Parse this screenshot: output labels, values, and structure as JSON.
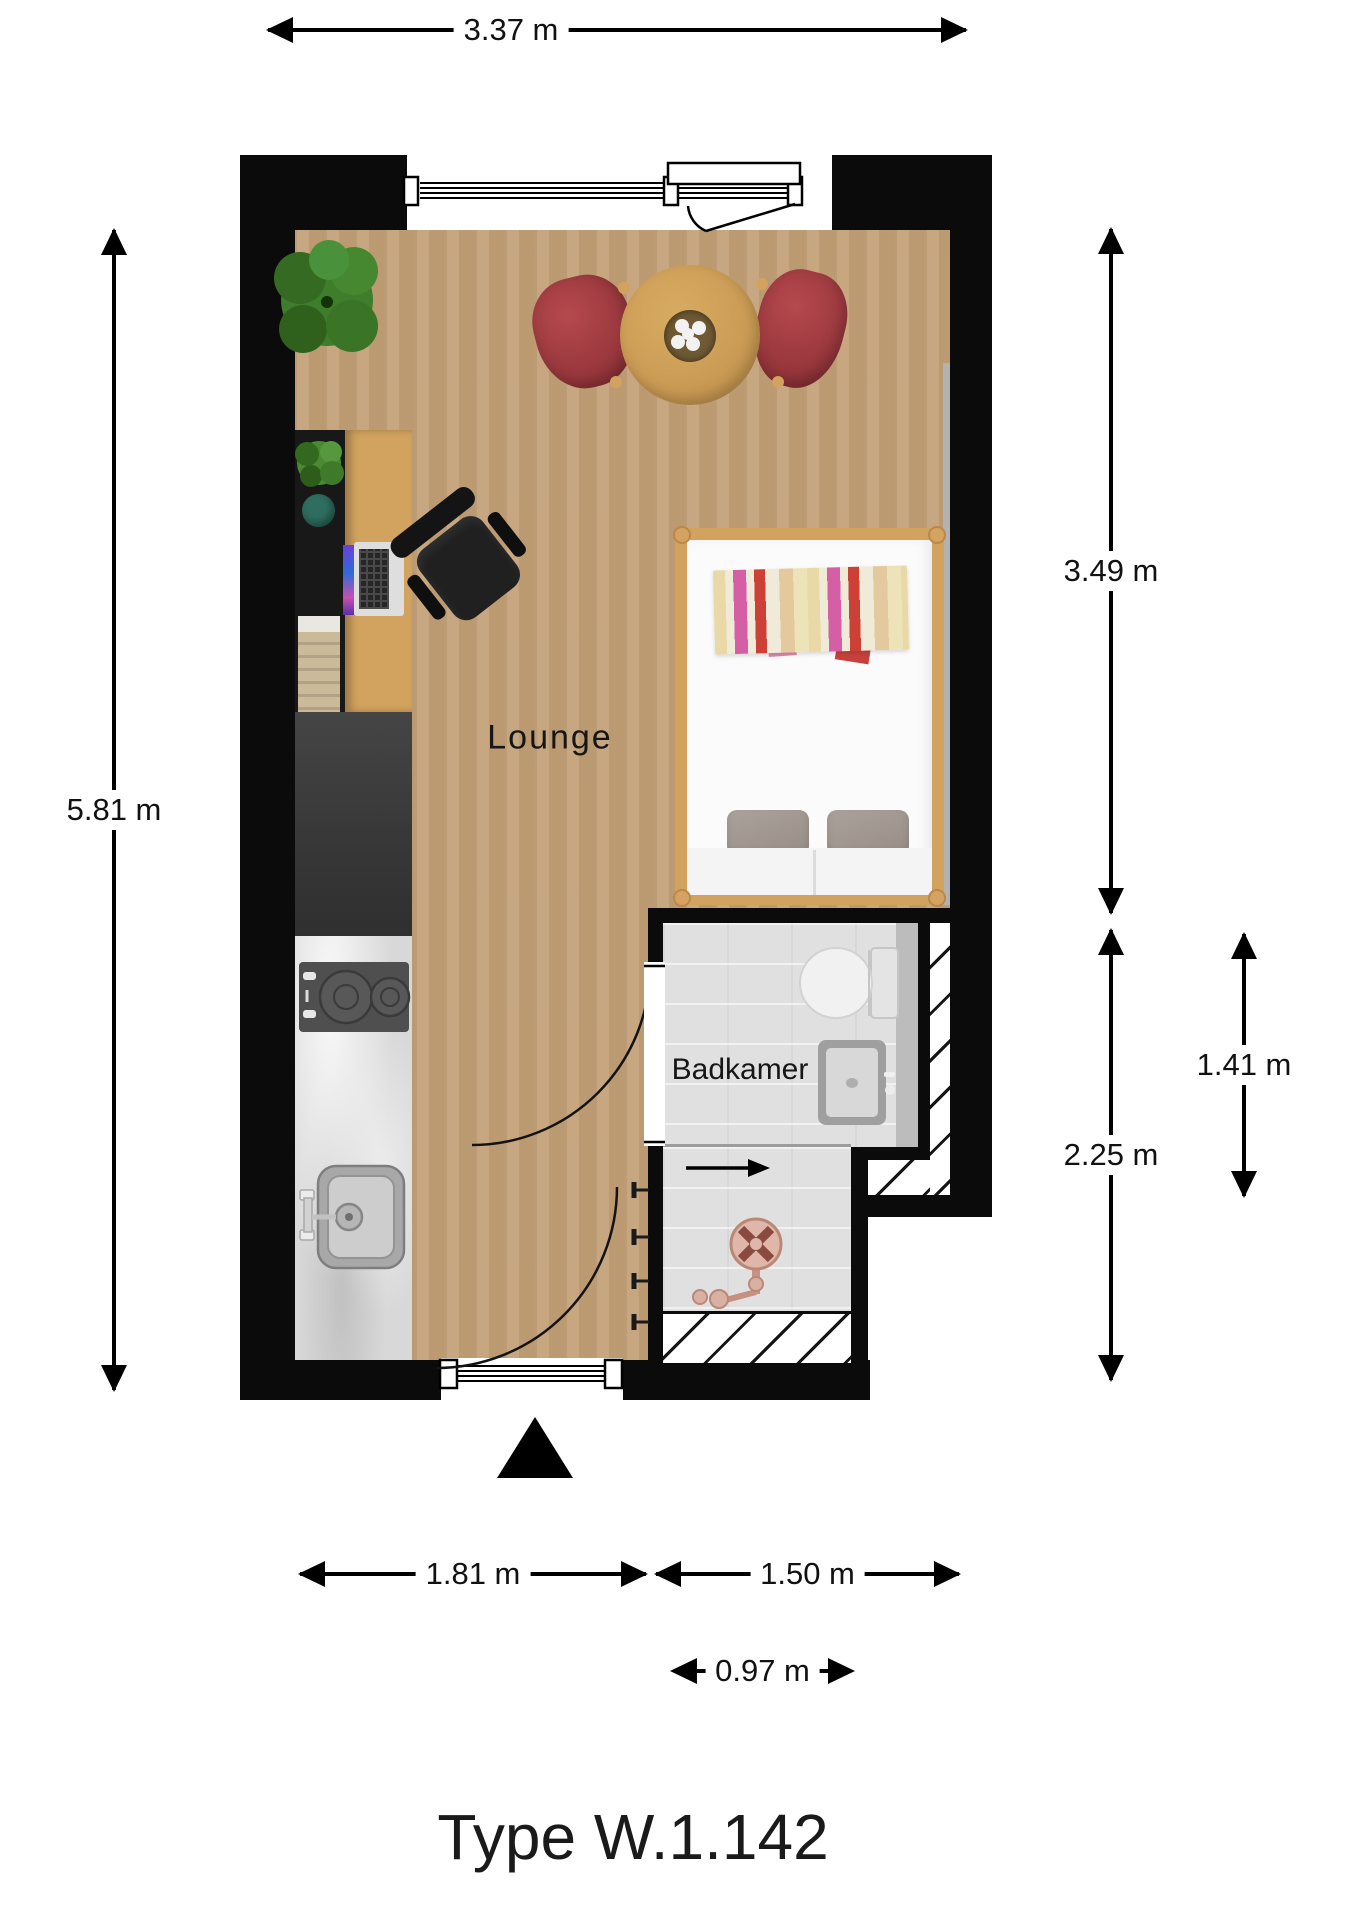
{
  "floorplan": {
    "title": "Type W.1.142",
    "rooms": {
      "lounge": "Lounge",
      "bathroom": "Badkamer"
    },
    "dimensions": {
      "top": "3.37 m",
      "left": "5.81 m",
      "right_upper": "3.49 m",
      "right_lower": "2.25 m",
      "bathroom_height": "1.41 m",
      "bottom_left": "1.81 m",
      "bottom_right": "1.50 m",
      "bathroom_width": "0.97 m"
    },
    "colors": {
      "wall": "#0b0b0b",
      "floor_wood": "#c3a077",
      "furniture_wood": "#d2a35f",
      "chair_red": "#a8393e",
      "tile_gray": "#e0e0e0",
      "fixture_copper": "#c5907f",
      "stool_teal": "#2e6e60",
      "plant_green": "#3e7d2b"
    }
  }
}
